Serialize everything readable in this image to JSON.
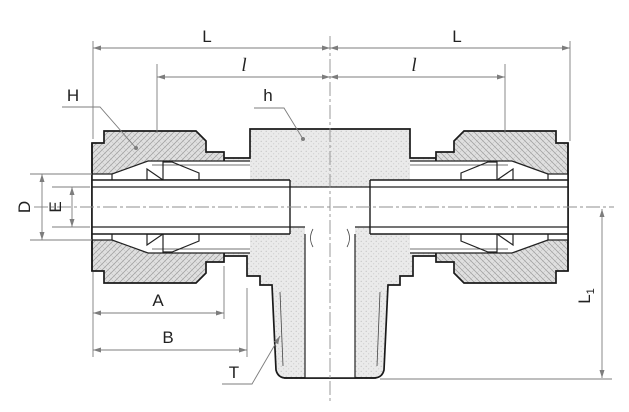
{
  "drawing": {
    "description": "Cross-section technical drawing of a male branch tee compression tube fitting",
    "dimension_labels": {
      "length_left": "L",
      "length_right": "L",
      "sub_length_left": "l",
      "sub_length_right": "l",
      "nut_hex": "H",
      "body_hex": "h",
      "outer_dia": "D",
      "bore_dia": "E",
      "nut_length": "A",
      "body_length": "B",
      "thread": "T",
      "branch_length": "L",
      "branch_length_sub": "1"
    },
    "colors": {
      "outline": "#1a1a1a",
      "dimension_line": "#7d7d7d",
      "body_fill": "#eaeaea",
      "nut_fill": "#dfdfdf",
      "background": "#ffffff"
    }
  }
}
